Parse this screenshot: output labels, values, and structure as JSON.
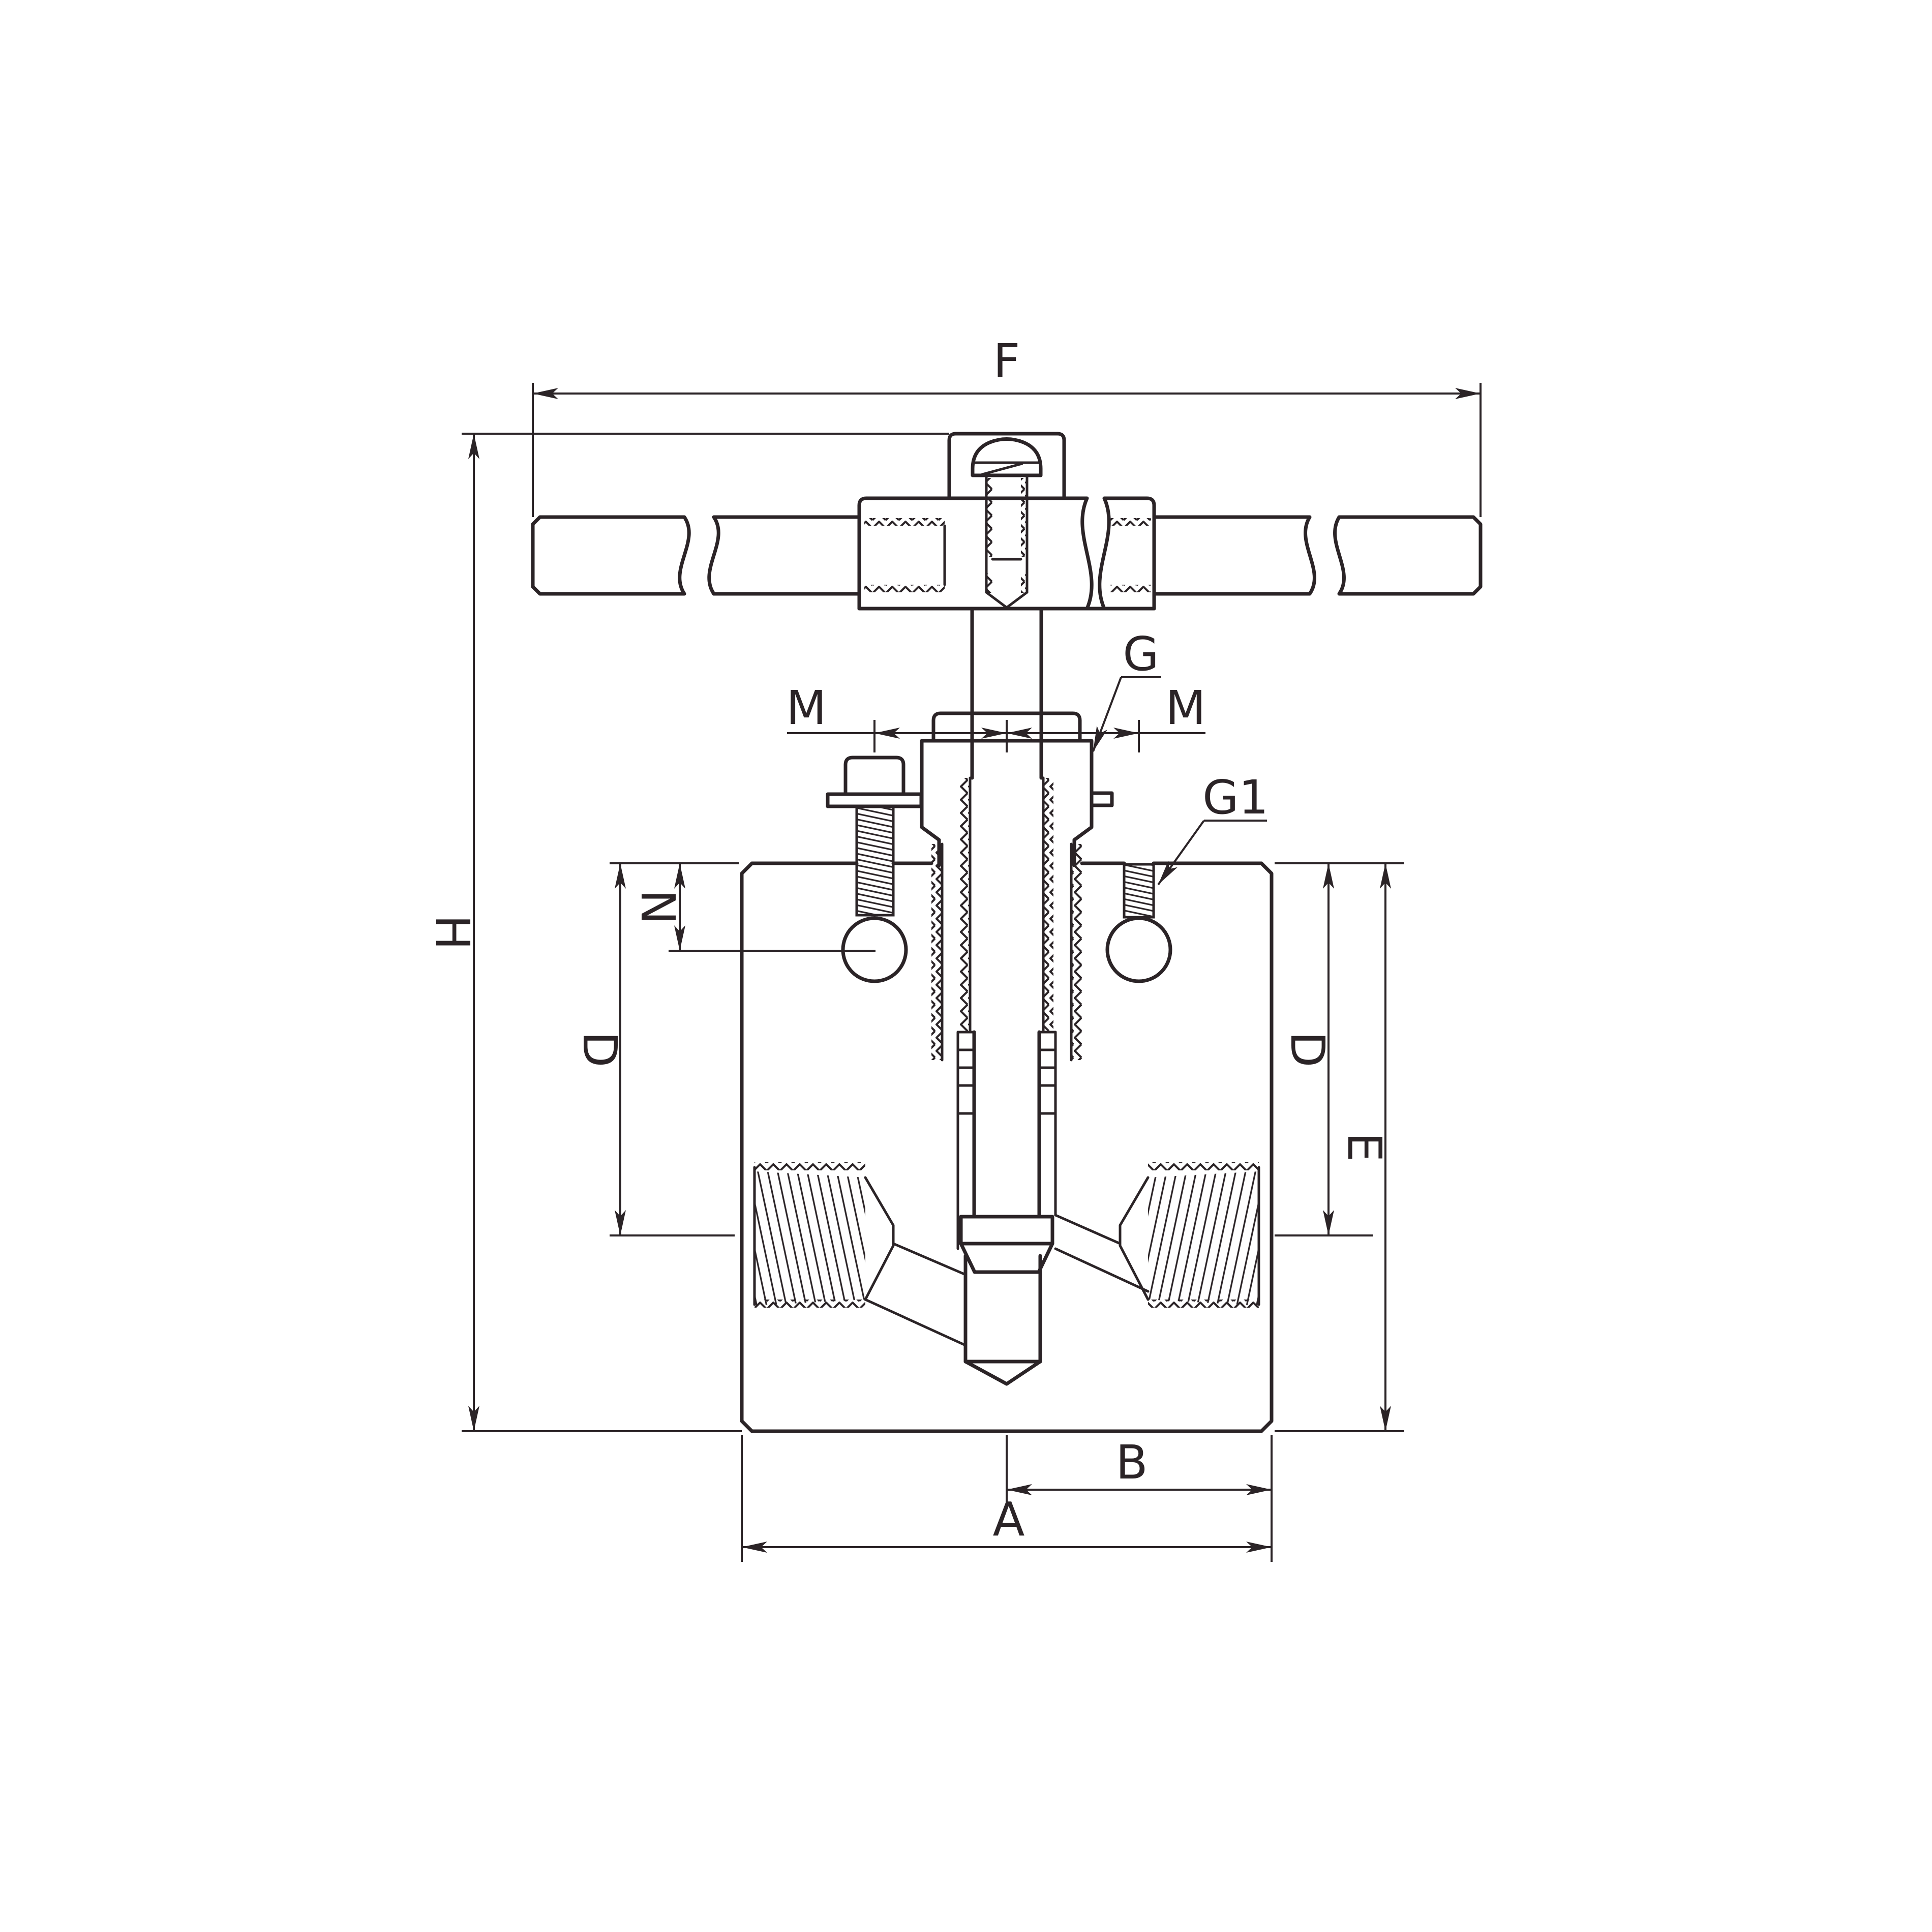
{
  "figure": {
    "kind": "technical-drawing",
    "subject": "needle-valve-cross-section",
    "background_color": "#ffffff",
    "line_color": "#2b2427"
  },
  "labels": {
    "F": "F",
    "H": "H",
    "M_left": "M",
    "M_right": "M",
    "G": "G",
    "G1": "G1",
    "N": "N",
    "D_left": "D",
    "D_right": "D",
    "E": "E",
    "B": "B",
    "A": "A"
  }
}
